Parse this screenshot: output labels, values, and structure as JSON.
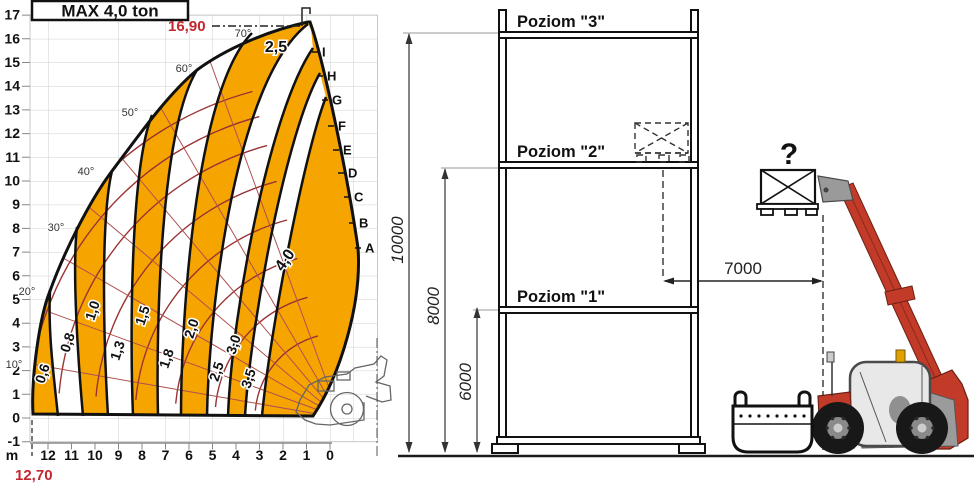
{
  "load_chart": {
    "title": "MAX 4,0 ton",
    "max_height_label": "16,90",
    "max_reach_label": "12,70",
    "axis_unit": "m",
    "y_ticks": [
      "17",
      "16",
      "15",
      "14",
      "13",
      "12",
      "11",
      "10",
      "9",
      "8",
      "7",
      "6",
      "5",
      "4",
      "3",
      "2",
      "1",
      "0",
      "-1"
    ],
    "x_ticks": [
      "12",
      "11",
      "10",
      "9",
      "8",
      "7",
      "6",
      "5",
      "4",
      "3",
      "2",
      "1",
      "0"
    ],
    "angle_labels": [
      "70°",
      "60°",
      "50°",
      "40°",
      "30°",
      "20°",
      "10°"
    ],
    "zone_labels": [
      "0,6",
      "0,8",
      "1,0",
      "1,3",
      "1,5",
      "1,8",
      "2,0",
      "2,5",
      "3,0",
      "3,5"
    ],
    "max_zone_label": "4,0",
    "top_zone_label": "2,5",
    "boundary_letters": [
      "I",
      "H",
      "G",
      "F",
      "E",
      "D",
      "C",
      "B",
      "A"
    ],
    "colors": {
      "zone_orange": "#F6A500",
      "web_red": "#9a3333",
      "label_red": "#C1272D"
    }
  },
  "rack_diagram": {
    "levels": [
      {
        "label": "Poziom \"3\""
      },
      {
        "label": "Poziom \"2\""
      },
      {
        "label": "Poziom \"1\""
      }
    ],
    "dimensions": {
      "total_height": "10000",
      "level2_height": "8000",
      "level1_height": "6000",
      "horizontal_reach": "7000"
    },
    "unknown_load_label": "?",
    "colors": {
      "machine_red": "#C23A28"
    }
  }
}
